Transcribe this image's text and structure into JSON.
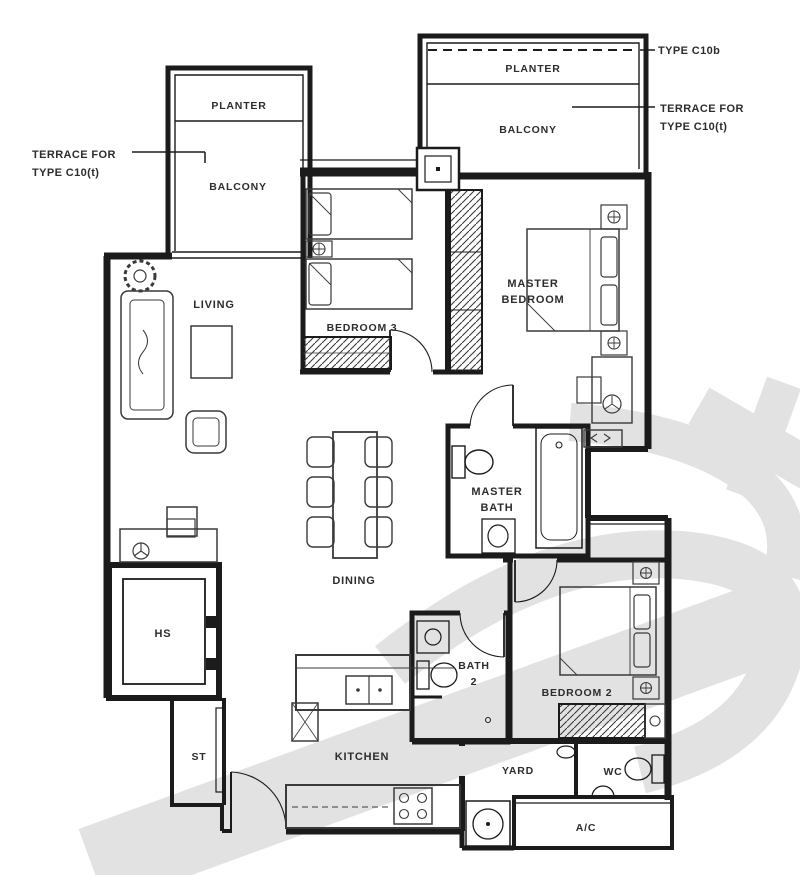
{
  "labels": {
    "type_ref": "TYPE C10b",
    "terrace_right": [
      "TERRACE FOR",
      "TYPE C10(t)"
    ],
    "terrace_left": [
      "TERRACE FOR",
      "TYPE C10(t)"
    ],
    "planter_right": "PLANTER",
    "balcony_right": "BALCONY",
    "planter_left": "PLANTER",
    "balcony_left": "BALCONY",
    "living": "LIVING",
    "bedroom3": "BEDROOM 3",
    "master_bedroom": [
      "MASTER",
      "BEDROOM"
    ],
    "master_bath": [
      "MASTER",
      "BATH"
    ],
    "dining": "DINING",
    "hs": "HS",
    "st": "ST",
    "kitchen": "KITCHEN",
    "bath2": [
      "BATH",
      "2"
    ],
    "bedroom2": "BEDROOM 2",
    "yard": "YARD",
    "wc": "WC",
    "ac": "A/C"
  },
  "colors": {
    "wall": "#1b1b1b",
    "furniture": "#3a3a3a",
    "text": "#2d2d2d",
    "watermark": "#c6c6c6",
    "background": "#ffffff"
  }
}
